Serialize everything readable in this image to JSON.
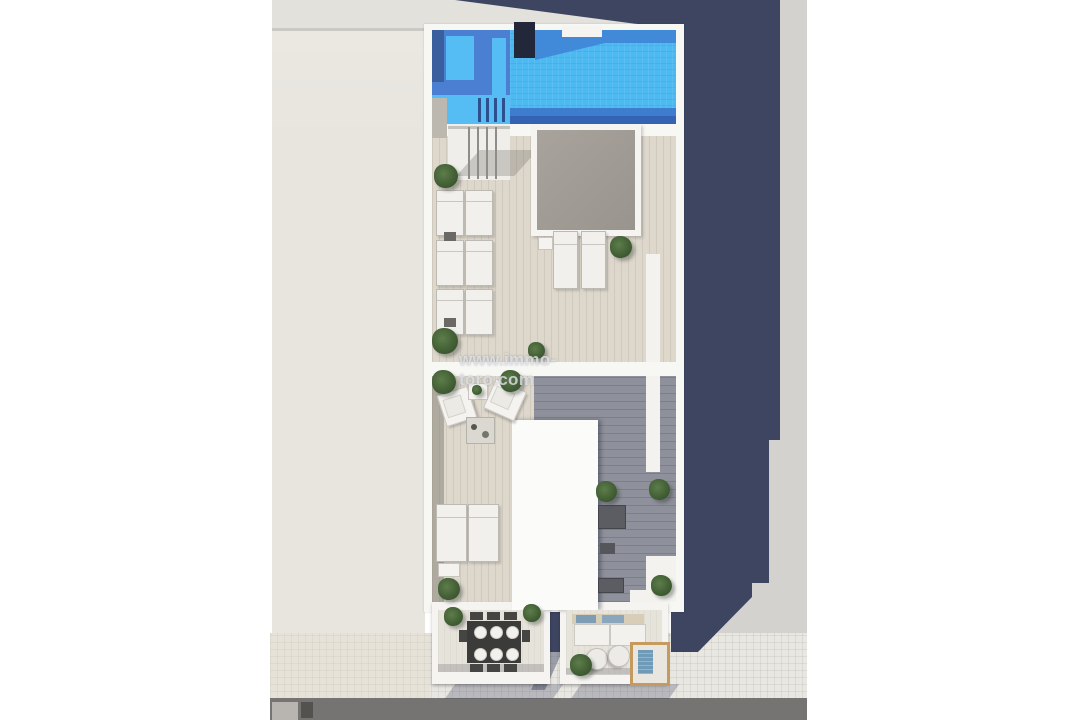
{
  "watermark": {
    "text": "www.immo-toro.com"
  },
  "regions": {
    "scene": "Aerial 3D rendering of a rooftop floor plan",
    "pool": "Rooftop swimming pool",
    "spa": "Raised spa and pool steps",
    "chimney": "Rooftop chimney block",
    "skylight": "Central skylight opening",
    "upper_terrace": "Upper sun terrace with loungers",
    "lower_terrace": "Lower terrace with lounge seating",
    "left_balcony": "Balcony with outdoor dining table",
    "right_balcony": "Balcony with sofa and daybed",
    "neighbor_roof": "Adjacent building roof",
    "sidewalk": "Tiled sidewalk",
    "road": "Street"
  },
  "colors": {
    "pool_bright": "#4cb9f1",
    "pool_shadow": "#3f85d6",
    "pool_mid": "#3e7ccd",
    "pool_dark": "#3363b2",
    "spa_blue": "#4a7fd1",
    "navy_shadow": "#3d4561",
    "building_white": "#f7f7f4",
    "deck_light": "#ddd7cc",
    "deck_shaded": "#8e919b",
    "skylight_gray": "#a39e97",
    "roof_beige": "#e7e5de",
    "top_band": "#e3e1dc",
    "ground_gray": "#d4d2ce",
    "sidewalk": "#e9e7e1",
    "road": "#767472",
    "plant_green": "#4e7040",
    "wood_tan": "#c49a5e",
    "cushion_blue": "#6f9ab8",
    "chimney": "#23273a"
  }
}
